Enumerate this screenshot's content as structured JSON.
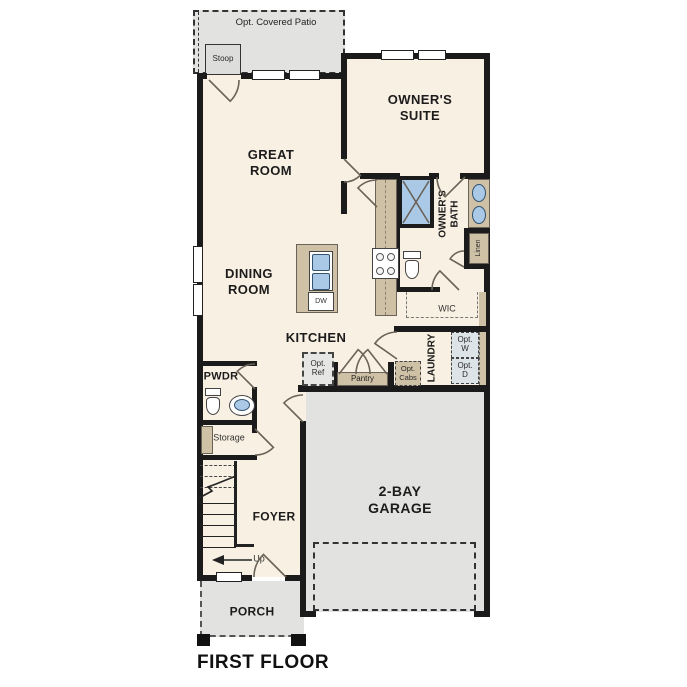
{
  "title": "FIRST FLOOR",
  "labels": {
    "patio": "Opt. Covered Patio",
    "stoop": "Stoop",
    "great_room": "GREAT\nROOM",
    "owners_suite": "OWNER'S\nSUITE",
    "dining_room": "DINING\nROOM",
    "kitchen": "KITCHEN",
    "owners_bath": "OWNER'S\nBATH",
    "linen": "Linen",
    "wic": "WIC",
    "laundry": "LAUNDRY",
    "opt_w": "Opt.\nW",
    "opt_d": "Opt.\nD",
    "opt_cabs": "Opt.\nCabs",
    "opt_ref": "Opt.\nRef",
    "pantry": "Pantry",
    "dw": "DW",
    "pwdr": "PWDR",
    "storage": "Storage",
    "foyer": "FOYER",
    "up": "Up",
    "garage": "2-BAY\nGARAGE",
    "porch": "PORCH"
  },
  "colors": {
    "floor": "#f8f0e2",
    "outdoor": "#e2e2e0",
    "wall": "#1b1b1b",
    "casework": "#cfc1a5",
    "fixture": "#a9c9e7",
    "appliance": "#dde4e7"
  }
}
